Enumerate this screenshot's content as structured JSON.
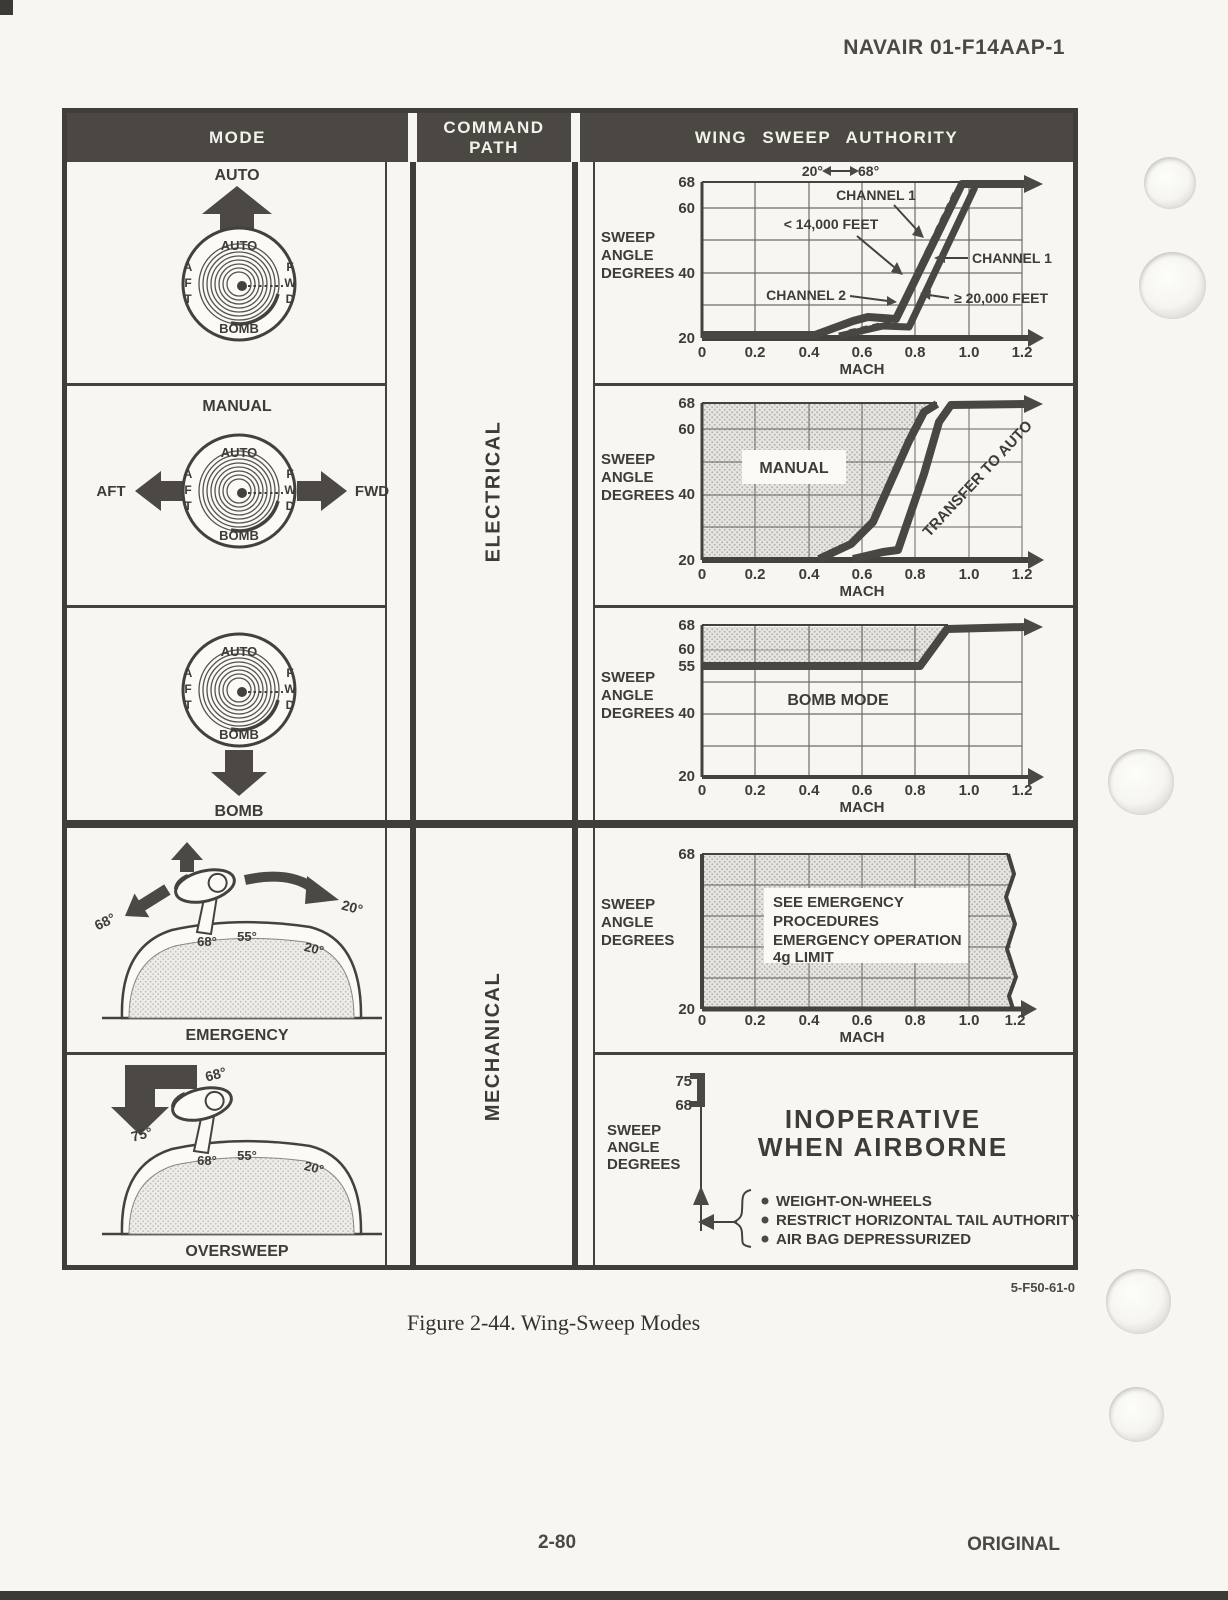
{
  "page": {
    "doc_ref": "NAVAIR 01-F14AAP-1",
    "figure_ref": "5-F50-61-0",
    "figure_caption": "Figure 2-44. Wing-Sweep Modes",
    "page_number": "2-80",
    "edition": "ORIGINAL"
  },
  "table": {
    "headers": {
      "mode": "MODE",
      "command_path": "COMMAND PATH",
      "authority": "WING SWEEP AUTHORITY"
    },
    "command_paths": {
      "electrical": "ELECTRICAL",
      "mechanical": "MECHANICAL"
    },
    "dial": {
      "top": "AUTO",
      "bottom": "BOMB",
      "left": [
        "A",
        "F",
        "T"
      ],
      "right": [
        "F",
        "W",
        "D"
      ]
    },
    "modes": {
      "auto": {
        "title": "AUTO"
      },
      "manual": {
        "title": "MANUAL",
        "aft": "AFT",
        "fwd": "FWD"
      },
      "bomb": {
        "title": "BOMB"
      },
      "emergency": {
        "title": "EMERGENCY",
        "arrow_left": "68°",
        "arrow_right": "20°",
        "quad": [
          "68°",
          "55°",
          "20°"
        ]
      },
      "oversweep": {
        "title": "OVERSWEEP",
        "arrow_top": "68°",
        "arrow_down": "75°",
        "quad": [
          "68°",
          "55°",
          "20°"
        ]
      }
    }
  },
  "charts": {
    "xlabel": "MACH",
    "ylabel": [
      "SWEEP",
      "ANGLE",
      "DEGREES"
    ],
    "xticks": [
      "0",
      "0.2",
      "0.4",
      "0.6",
      "0.8",
      "1.0",
      "1.2"
    ],
    "auto": {
      "yticks": [
        "68",
        "60",
        "40",
        "20"
      ],
      "range_low": "20°",
      "range_high": "68°",
      "channel1_top": "CHANNEL 1",
      "alt_low": "< 14,000 FEET",
      "channel1_right": "CHANNEL 1",
      "channel2": "CHANNEL 2",
      "alt_high": "≥ 20,000 FEET"
    },
    "manual": {
      "yticks": [
        "68",
        "60",
        "40",
        "20"
      ],
      "region": "MANUAL",
      "note": "TRANSFER TO AUTO"
    },
    "bomb": {
      "yticks": [
        "68",
        "60",
        "55",
        "40",
        "20"
      ],
      "label": "BOMB MODE"
    },
    "emergency": {
      "yticks": [
        "68",
        "20"
      ],
      "note": [
        "SEE EMERGENCY",
        "PROCEDURES",
        "EMERGENCY OPERATION",
        "4g LIMIT"
      ]
    },
    "inoperative": {
      "yticks": [
        "75",
        "68"
      ],
      "title": [
        "INOPERATIVE",
        "WHEN AIRBORNE"
      ],
      "conditions": [
        "WEIGHT-ON-WHEELS",
        "RESTRICT HORIZONTAL TAIL AUTHORITY",
        "AIR BAG DEPRESSURIZED"
      ]
    }
  },
  "chart_data": [
    {
      "type": "line",
      "panel": "auto-mode",
      "xlabel": "MACH",
      "ylabel": "SWEEP ANGLE DEGREES",
      "xlim": [
        0,
        1.3
      ],
      "ylim": [
        20,
        68
      ],
      "xticks": [
        0,
        0.2,
        0.4,
        0.6,
        0.8,
        1.0,
        1.2
      ],
      "yticks": [
        68,
        60,
        40,
        20
      ],
      "grid": true,
      "series": [
        {
          "name": "CHANNEL 1 < 14,000 FEET",
          "style": "thick",
          "points": [
            [
              0,
              20
            ],
            [
              0.42,
              20
            ],
            [
              0.57,
              25
            ],
            [
              0.62,
              26
            ],
            [
              0.73,
              26
            ],
            [
              0.98,
              68
            ],
            [
              1.3,
              68
            ]
          ]
        },
        {
          "name": "CHANNEL 1 ≥ 20,000 FEET",
          "style": "thick",
          "points": [
            [
              0.51,
              20
            ],
            [
              0.68,
              23
            ],
            [
              0.78,
              23
            ],
            [
              1.02,
              68
            ]
          ]
        },
        {
          "name": "CHANNEL 2",
          "style": "dashed",
          "points": [
            [
              0.55,
              21
            ],
            [
              0.72,
              24
            ],
            [
              0.95,
              66
            ]
          ]
        }
      ],
      "annotations": [
        "20° ↔ 68°",
        "CHANNEL 1",
        "< 14,000 FEET",
        "CHANNEL 2",
        "CHANNEL 1",
        "≥ 20,000 FEET"
      ]
    },
    {
      "type": "area",
      "panel": "manual-mode",
      "xlabel": "MACH",
      "ylabel": "SWEEP ANGLE DEGREES",
      "xlim": [
        0,
        1.3
      ],
      "ylim": [
        20,
        68
      ],
      "yticks": [
        68,
        60,
        40,
        20
      ],
      "region_label": "MANUAL",
      "note": "TRANSFER TO AUTO",
      "region_boundary": [
        [
          0,
          20
        ],
        [
          0.47,
          20
        ],
        [
          0.57,
          26
        ],
        [
          0.64,
          34
        ],
        [
          0.71,
          50
        ],
        [
          0.78,
          60
        ],
        [
          0.84,
          65
        ],
        [
          0.88,
          68
        ],
        [
          0,
          68
        ]
      ]
    },
    {
      "type": "line",
      "panel": "bomb-mode",
      "xlabel": "MACH",
      "ylabel": "SWEEP ANGLE DEGREES",
      "xlim": [
        0,
        1.3
      ],
      "ylim": [
        20,
        68
      ],
      "yticks": [
        68,
        60,
        55,
        40,
        20
      ],
      "label": "BOMB MODE",
      "shaded_band": [
        55,
        68
      ],
      "series": [
        {
          "name": "sweep limit",
          "style": "thick",
          "points": [
            [
              0,
              55
            ],
            [
              0.82,
              55
            ],
            [
              0.92,
              68
            ],
            [
              1.3,
              68
            ]
          ]
        }
      ]
    },
    {
      "type": "area",
      "panel": "emergency-mode",
      "xlabel": "MACH",
      "ylabel": "SWEEP ANGLE DEGREES",
      "xlim": [
        0,
        1.3
      ],
      "ylim": [
        20,
        68
      ],
      "yticks": [
        68,
        20
      ],
      "note": "SEE EMERGENCY PROCEDURES EMERGENCY OPERATION 4g LIMIT",
      "region": "full envelope shaded 20-68 degrees, all mach"
    },
    {
      "type": "diagram",
      "panel": "oversweep-mode",
      "ylabel": "SWEEP ANGLE DEGREES",
      "values": [
        75,
        68
      ],
      "note": "INOPERATIVE WHEN AIRBORNE",
      "conditions": [
        "WEIGHT-ON-WHEELS",
        "RESTRICT HORIZONTAL TAIL AUTHORITY",
        "AIR BAG DEPRESSURIZED"
      ]
    }
  ]
}
